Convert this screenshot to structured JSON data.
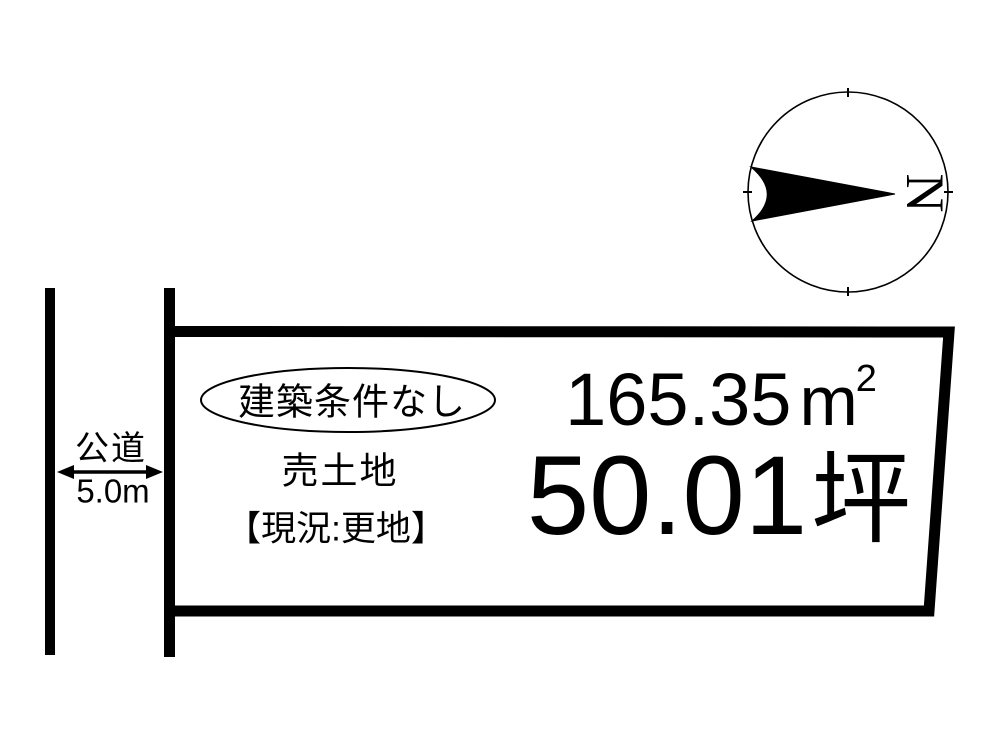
{
  "colors": {
    "ink": "#000000",
    "background": "#ffffff"
  },
  "compass": {
    "label": "N",
    "orientation": "north-points-right"
  },
  "road": {
    "label": "公道",
    "width": "5.0m"
  },
  "plot": {
    "badge": "建築条件なし",
    "title": "売土地",
    "status": "【現況:更地】",
    "area_sqm": {
      "value": "165.35",
      "unit_base": "m",
      "unit_exponent": "2"
    },
    "area_tsubo": {
      "value": "50.01",
      "unit": "坪"
    }
  }
}
